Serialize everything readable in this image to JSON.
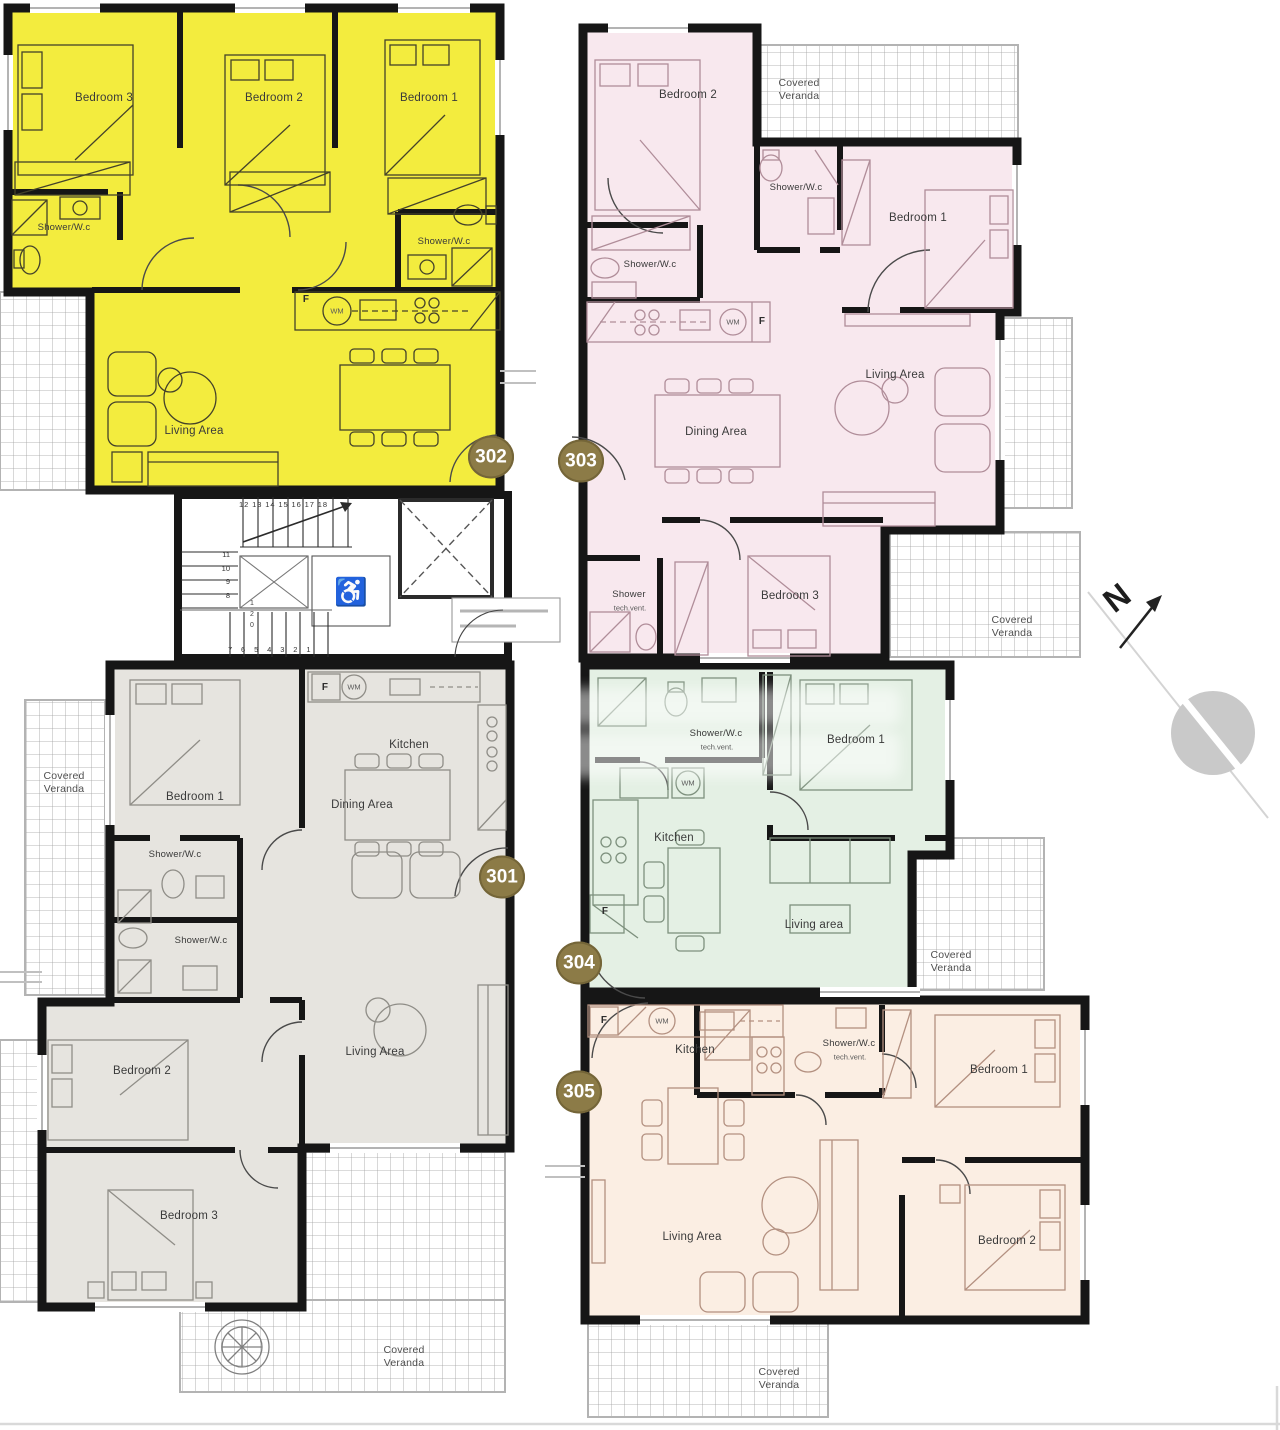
{
  "badges": {
    "b301": "301",
    "b302": "302",
    "b303": "303",
    "b304": "304",
    "b305": "305"
  },
  "compass": {
    "letter": "N"
  },
  "stairs": {
    "top": "12 13 14 15 16 17 18",
    "left": "11\n10\n9\n8",
    "bottom": "7 6 5 4 3 2 1",
    "riser": "1\n2\n0"
  },
  "u302": {
    "bed3": "Bedroom 3",
    "bed2": "Bedroom 2",
    "bed1": "Bedroom 1",
    "shower1": "Shower/W.c",
    "shower2": "Shower/W.c",
    "living": "Living Area",
    "f": "F",
    "wm": "WM"
  },
  "u303": {
    "bed2": "Bedroom 2",
    "veranda_top": "Covered\nVeranda",
    "shower1": "Shower/W.c",
    "bed1": "Bedroom 1",
    "shower2": "Shower/W.c",
    "wm": "WM",
    "f": "F",
    "dining": "Dining Area",
    "living": "Living Area",
    "shower3": "Shower",
    "tech": "tech.vent.",
    "bed3": "Bedroom 3",
    "veranda_bottom": "Covered\nVeranda"
  },
  "u301": {
    "f": "F",
    "wm": "WM",
    "kitchen": "Kitchen",
    "veranda_left": "Covered\nVeranda",
    "bed1": "Bedroom 1",
    "dining": "Dining Area",
    "shower1": "Shower/W.c",
    "shower2": "Shower/W.c",
    "living": "Living Area",
    "bed2": "Bedroom 2",
    "bed3": "Bedroom 3",
    "veranda_bottom": "Covered\nVeranda"
  },
  "u304": {
    "shower": "Shower/W.c",
    "tech": "tech.vent.",
    "bed1": "Bedroom 1",
    "wm": "WM",
    "kitchen": "Kitchen",
    "f": "F",
    "living": "Living area",
    "veranda": "Covered\nVeranda"
  },
  "u305": {
    "f": "F",
    "wm": "WM",
    "kitchen": "Kitchen",
    "shower": "Shower/W.c",
    "tech": "tech.vent.",
    "bed1": "Bedroom 1",
    "living": "Living Area",
    "bed2": "Bedroom 2",
    "veranda": "Covered\nVeranda"
  },
  "colors": {
    "unit302": "#f3ec3e",
    "unit303": "#f8e8ee",
    "unit301": "#e6e4df",
    "unit304": "#e4f0e4",
    "unit305": "#fbeee3",
    "walls": "#161616",
    "badge": "#8c7b47"
  }
}
